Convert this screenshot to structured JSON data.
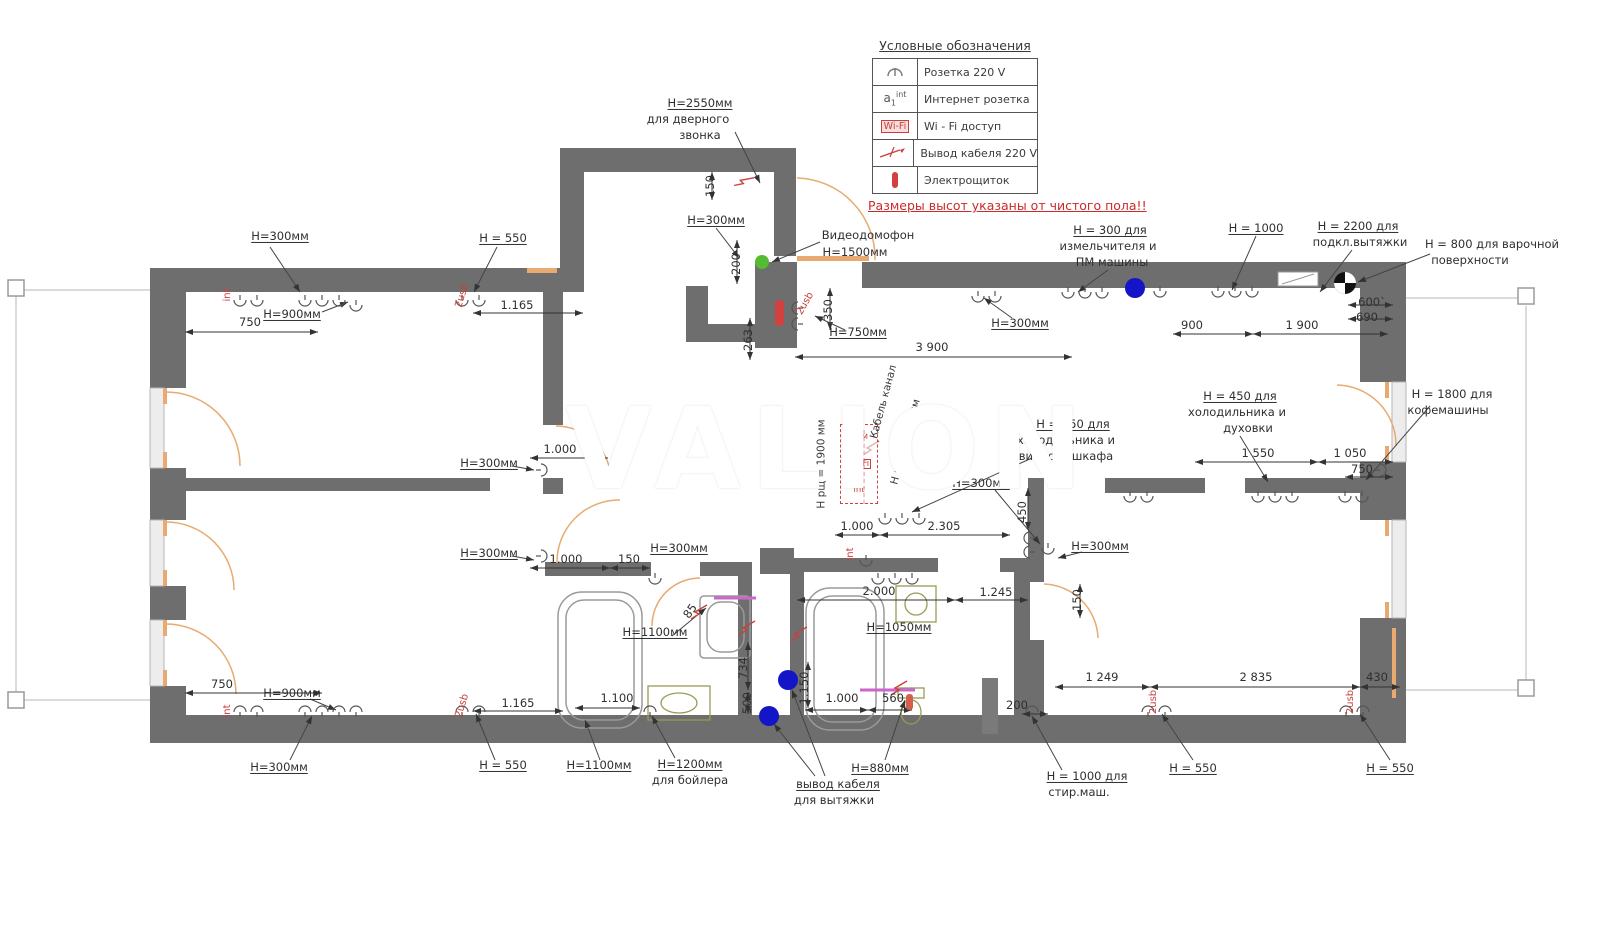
{
  "watermark": "VALION",
  "note": "Размеры высот указаны от чистого пола!!",
  "legend": {
    "title": "Условные обозначения",
    "rows": [
      {
        "symbol": "socket-icon",
        "label": "Розетка 220 V"
      },
      {
        "symbol": "internet-socket-icon",
        "label": "Интернет розетка"
      },
      {
        "symbol": "wifi-icon",
        "label": "Wi - Fi доступ"
      },
      {
        "symbol": "cable-icon",
        "label": "Вывод кабеля 220 V"
      },
      {
        "symbol": "panel-icon",
        "label": "Электрощиток"
      }
    ]
  },
  "wifi_box": {
    "lines": [
      "Адм",
      "Wi-Fi",
      "int"
    ]
  },
  "colors": {
    "wall": "#6e6e6e",
    "door": "#e8aa70",
    "red": "#c8403c",
    "blue": "#1515c8",
    "green": "#55bb33",
    "olive": "#9a9a55",
    "magenta": "#cc66cc"
  },
  "labels": [
    {
      "t": "H=2550мм",
      "x": 700,
      "y": 103,
      "cls": "h",
      "u": 1
    },
    {
      "t": "для дверного",
      "x": 688,
      "y": 119,
      "cls": "h"
    },
    {
      "t": "звонка",
      "x": 700,
      "y": 135,
      "cls": "h"
    },
    {
      "t": "H=300мм",
      "x": 716,
      "y": 220,
      "cls": "h",
      "u": 1
    },
    {
      "t": "Видеодомофон",
      "x": 868,
      "y": 235,
      "cls": "h"
    },
    {
      "t": "H=1500мм",
      "x": 855,
      "y": 252,
      "cls": "h"
    },
    {
      "t": "H = 300 для",
      "x": 1110,
      "y": 230,
      "cls": "h",
      "u": 1
    },
    {
      "t": "измельчителя и",
      "x": 1108,
      "y": 246,
      "cls": "h"
    },
    {
      "t": "ПМ машины",
      "x": 1112,
      "y": 262,
      "cls": "h"
    },
    {
      "t": "H = 1000",
      "x": 1256,
      "y": 228,
      "cls": "h",
      "u": 1
    },
    {
      "t": "H = 2200 для",
      "x": 1358,
      "y": 226,
      "cls": "h",
      "u": 1
    },
    {
      "t": "подкл.вытяжки",
      "x": 1360,
      "y": 242,
      "cls": "h"
    },
    {
      "t": "H = 800 для варочной",
      "x": 1492,
      "y": 244,
      "cls": "h"
    },
    {
      "t": "поверхности",
      "x": 1470,
      "y": 260,
      "cls": "h"
    },
    {
      "t": "H=300мм",
      "x": 280,
      "y": 236,
      "cls": "h",
      "u": 1
    },
    {
      "t": "H = 550",
      "x": 503,
      "y": 238,
      "cls": "h",
      "u": 1
    },
    {
      "t": "H=900мм",
      "x": 292,
      "y": 314,
      "cls": "h",
      "u": 1
    },
    {
      "t": "H=300мм",
      "x": 1020,
      "y": 323,
      "cls": "h",
      "u": 1
    },
    {
      "t": "H=750мм",
      "x": 858,
      "y": 332,
      "cls": "h",
      "u": 1
    },
    {
      "t": "H = 450 для",
      "x": 1240,
      "y": 396,
      "cls": "h",
      "u": 1
    },
    {
      "t": "холодильника и",
      "x": 1237,
      "y": 412,
      "cls": "h"
    },
    {
      "t": "духовки",
      "x": 1248,
      "y": 428,
      "cls": "h"
    },
    {
      "t": "H = 1800 для",
      "x": 1452,
      "y": 394,
      "cls": "h"
    },
    {
      "t": "кофемашины",
      "x": 1448,
      "y": 410,
      "cls": "h"
    },
    {
      "t": "H = 950 для",
      "x": 1073,
      "y": 424,
      "cls": "h",
      "u": 1
    },
    {
      "t": "холодильника и",
      "x": 1066,
      "y": 440,
      "cls": "h"
    },
    {
      "t": "винного шкафа",
      "x": 1066,
      "y": 456,
      "cls": "h"
    },
    {
      "t": "H=300мм",
      "x": 489,
      "y": 463,
      "cls": "h",
      "u": 1
    },
    {
      "t": "H=300мм",
      "x": 981,
      "y": 483,
      "cls": "h",
      "u": 1
    },
    {
      "t": "H=300мм",
      "x": 489,
      "y": 553,
      "cls": "h",
      "u": 1
    },
    {
      "t": "H=300мм",
      "x": 679,
      "y": 548,
      "cls": "h",
      "u": 1
    },
    {
      "t": "H=300мм",
      "x": 1100,
      "y": 546,
      "cls": "h",
      "u": 1
    },
    {
      "t": "H=1100мм",
      "x": 655,
      "y": 632,
      "cls": "h",
      "u": 1
    },
    {
      "t": "H=1050мм",
      "x": 899,
      "y": 627,
      "cls": "h",
      "u": 1
    },
    {
      "t": "H=900мм",
      "x": 292,
      "y": 693,
      "cls": "h",
      "u": 1
    },
    {
      "t": "H=300мм",
      "x": 279,
      "y": 767,
      "cls": "h",
      "u": 1
    },
    {
      "t": "H = 550",
      "x": 503,
      "y": 765,
      "cls": "h",
      "u": 1
    },
    {
      "t": "H=1100мм",
      "x": 599,
      "y": 765,
      "cls": "h",
      "u": 1
    },
    {
      "t": "H=1200мм",
      "x": 690,
      "y": 764,
      "cls": "h",
      "u": 1
    },
    {
      "t": "для бойлера",
      "x": 690,
      "y": 780,
      "cls": "h"
    },
    {
      "t": "вывод кабеля",
      "x": 838,
      "y": 784,
      "cls": "h",
      "u": 1
    },
    {
      "t": "для вытяжки",
      "x": 834,
      "y": 800,
      "cls": "h"
    },
    {
      "t": "H=880мм",
      "x": 880,
      "y": 768,
      "cls": "h",
      "u": 1
    },
    {
      "t": "H = 1000 для",
      "x": 1087,
      "y": 776,
      "cls": "h",
      "u": 1
    },
    {
      "t": "стир.маш.",
      "x": 1079,
      "y": 792,
      "cls": "h"
    },
    {
      "t": "H = 550",
      "x": 1193,
      "y": 768,
      "cls": "h",
      "u": 1
    },
    {
      "t": "H = 550",
      "x": 1390,
      "y": 768,
      "cls": "h",
      "u": 1
    },
    {
      "t": "150",
      "x": 710,
      "y": 186,
      "cls": "d",
      "rot": -90
    },
    {
      "t": "200",
      "x": 736,
      "y": 264,
      "cls": "d",
      "rot": -90
    },
    {
      "t": "750",
      "x": 250,
      "y": 322,
      "cls": "d"
    },
    {
      "t": "1.165",
      "x": 517,
      "y": 305,
      "cls": "d"
    },
    {
      "t": "900",
      "x": 1192,
      "y": 325,
      "cls": "d"
    },
    {
      "t": "1 900",
      "x": 1302,
      "y": 325,
      "cls": "d"
    },
    {
      "t": "600`",
      "x": 1372,
      "y": 302,
      "cls": "d"
    },
    {
      "t": "690",
      "x": 1367,
      "y": 317,
      "cls": "d"
    },
    {
      "t": "3 900",
      "x": 932,
      "y": 347,
      "cls": "d"
    },
    {
      "t": "350",
      "x": 828,
      "y": 310,
      "cls": "d",
      "rot": -90
    },
    {
      "t": "263",
      "x": 748,
      "y": 340,
      "cls": "d",
      "rot": -90
    },
    {
      "t": "1.000",
      "x": 560,
      "y": 449,
      "cls": "d"
    },
    {
      "t": "1 550",
      "x": 1258,
      "y": 453,
      "cls": "d"
    },
    {
      "t": "1 050",
      "x": 1350,
      "y": 453,
      "cls": "d"
    },
    {
      "t": "750",
      "x": 1362,
      "y": 469,
      "cls": "d"
    },
    {
      "t": "1.000",
      "x": 857,
      "y": 526,
      "cls": "d"
    },
    {
      "t": "2.305",
      "x": 944,
      "y": 526,
      "cls": "d"
    },
    {
      "t": "450",
      "x": 1022,
      "y": 512,
      "cls": "d",
      "rot": -90
    },
    {
      "t": "1.000",
      "x": 566,
      "y": 559,
      "cls": "d"
    },
    {
      "t": "150",
      "x": 629,
      "y": 559,
      "cls": "d"
    },
    {
      "t": "2.000",
      "x": 879,
      "y": 591,
      "cls": "d"
    },
    {
      "t": "1.245",
      "x": 996,
      "y": 592,
      "cls": "d"
    },
    {
      "t": "150",
      "x": 1077,
      "y": 600,
      "cls": "d",
      "rot": -90
    },
    {
      "t": "85",
      "x": 690,
      "y": 611,
      "cls": "d",
      "rot": -55
    },
    {
      "t": "734",
      "x": 743,
      "y": 668,
      "cls": "d",
      "rot": -90
    },
    {
      "t": "500",
      "x": 747,
      "y": 703,
      "cls": "d",
      "rot": -90
    },
    {
      "t": "1.100",
      "x": 617,
      "y": 698,
      "cls": "d"
    },
    {
      "t": "1.150",
      "x": 804,
      "y": 688,
      "cls": "d",
      "rot": -90
    },
    {
      "t": "1.000",
      "x": 842,
      "y": 698,
      "cls": "d"
    },
    {
      "t": "560",
      "x": 893,
      "y": 698,
      "cls": "d"
    },
    {
      "t": "200",
      "x": 1017,
      "y": 705,
      "cls": "d"
    },
    {
      "t": "1 249",
      "x": 1102,
      "y": 677,
      "cls": "d"
    },
    {
      "t": "2 835",
      "x": 1256,
      "y": 677,
      "cls": "d"
    },
    {
      "t": "430",
      "x": 1377,
      "y": 677,
      "cls": "d"
    },
    {
      "t": "750",
      "x": 222,
      "y": 684,
      "cls": "d"
    },
    {
      "t": "1.165",
      "x": 518,
      "y": 703,
      "cls": "d"
    },
    {
      "t": "int",
      "x": 228,
      "y": 295,
      "cls": "r",
      "rot": -90
    },
    {
      "t": "2usb",
      "x": 463,
      "y": 296,
      "cls": "r",
      "rot": -73
    },
    {
      "t": "2usb",
      "x": 806,
      "y": 304,
      "cls": "r",
      "rot": -60
    },
    {
      "t": "int",
      "x": 851,
      "y": 554,
      "cls": "r",
      "rot": -90
    },
    {
      "t": "int",
      "x": 228,
      "y": 711,
      "cls": "r",
      "rot": -90
    },
    {
      "t": "2usb",
      "x": 463,
      "y": 706,
      "cls": "r",
      "rot": -73
    },
    {
      "t": "2usb",
      "x": 1154,
      "y": 702,
      "cls": "r",
      "rot": -90
    },
    {
      "t": "2usb",
      "x": 1351,
      "y": 702,
      "cls": "r",
      "rot": -90
    },
    {
      "t": "Кабель канал",
      "x": 884,
      "y": 402,
      "cls": "v",
      "rot": -75
    },
    {
      "t": "Н роз. =1550мм",
      "x": 906,
      "y": 442,
      "cls": "v",
      "rot": -75
    },
    {
      "t": "Н рщ = 1900 мм",
      "x": 822,
      "y": 464,
      "cls": "v",
      "rot": -90
    }
  ]
}
